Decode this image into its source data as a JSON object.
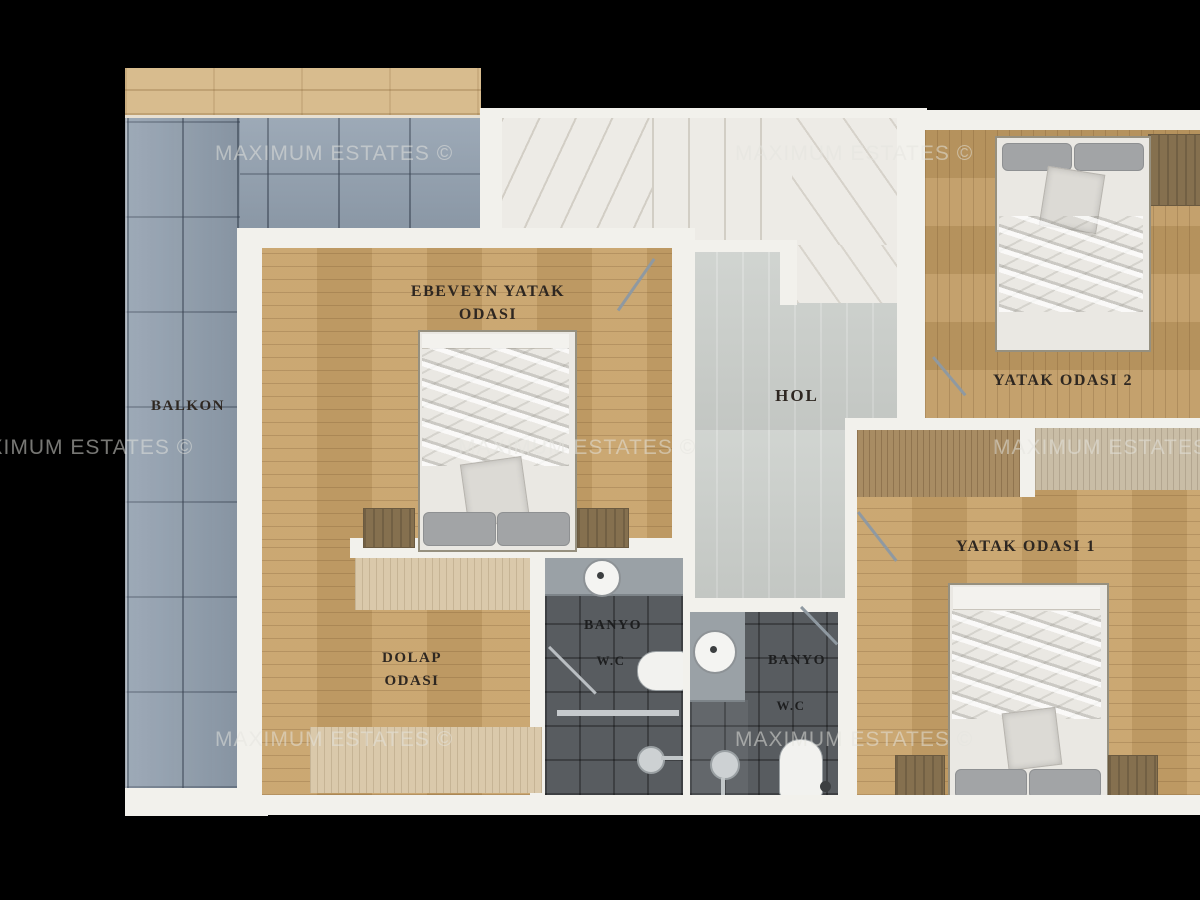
{
  "watermark": {
    "text": "MAXIMUM ESTATES ©"
  },
  "rooms": {
    "balcony": {
      "label": "BALKON"
    },
    "master_bedroom": {
      "label_line1": "EBEVEYN YATAK",
      "label_line2": "ODASI"
    },
    "hall": {
      "label": "HOL"
    },
    "bedroom2": {
      "label": "YATAK ODASI 2"
    },
    "bedroom1": {
      "label": "YATAK ODASI 1"
    },
    "closet_room": {
      "label_line1": "DOLAP",
      "label_line2": "ODASI"
    },
    "bathroom_left": {
      "label": "BANYO",
      "wc_label": "W.C"
    },
    "bathroom_right": {
      "label": "BANYO",
      "wc_label": "W.C"
    }
  },
  "colors": {
    "background": "#000000",
    "wall": "#f2f1ec",
    "wood_floor": "#c7a168",
    "balcony_tile": "#92a0af",
    "bathroom_floor": "#585c60",
    "hall_floor": "#cdd1cd",
    "stairs_marble": "#edebe6",
    "label_text": "#2e2721",
    "watermark_text": "#e4e4de"
  }
}
